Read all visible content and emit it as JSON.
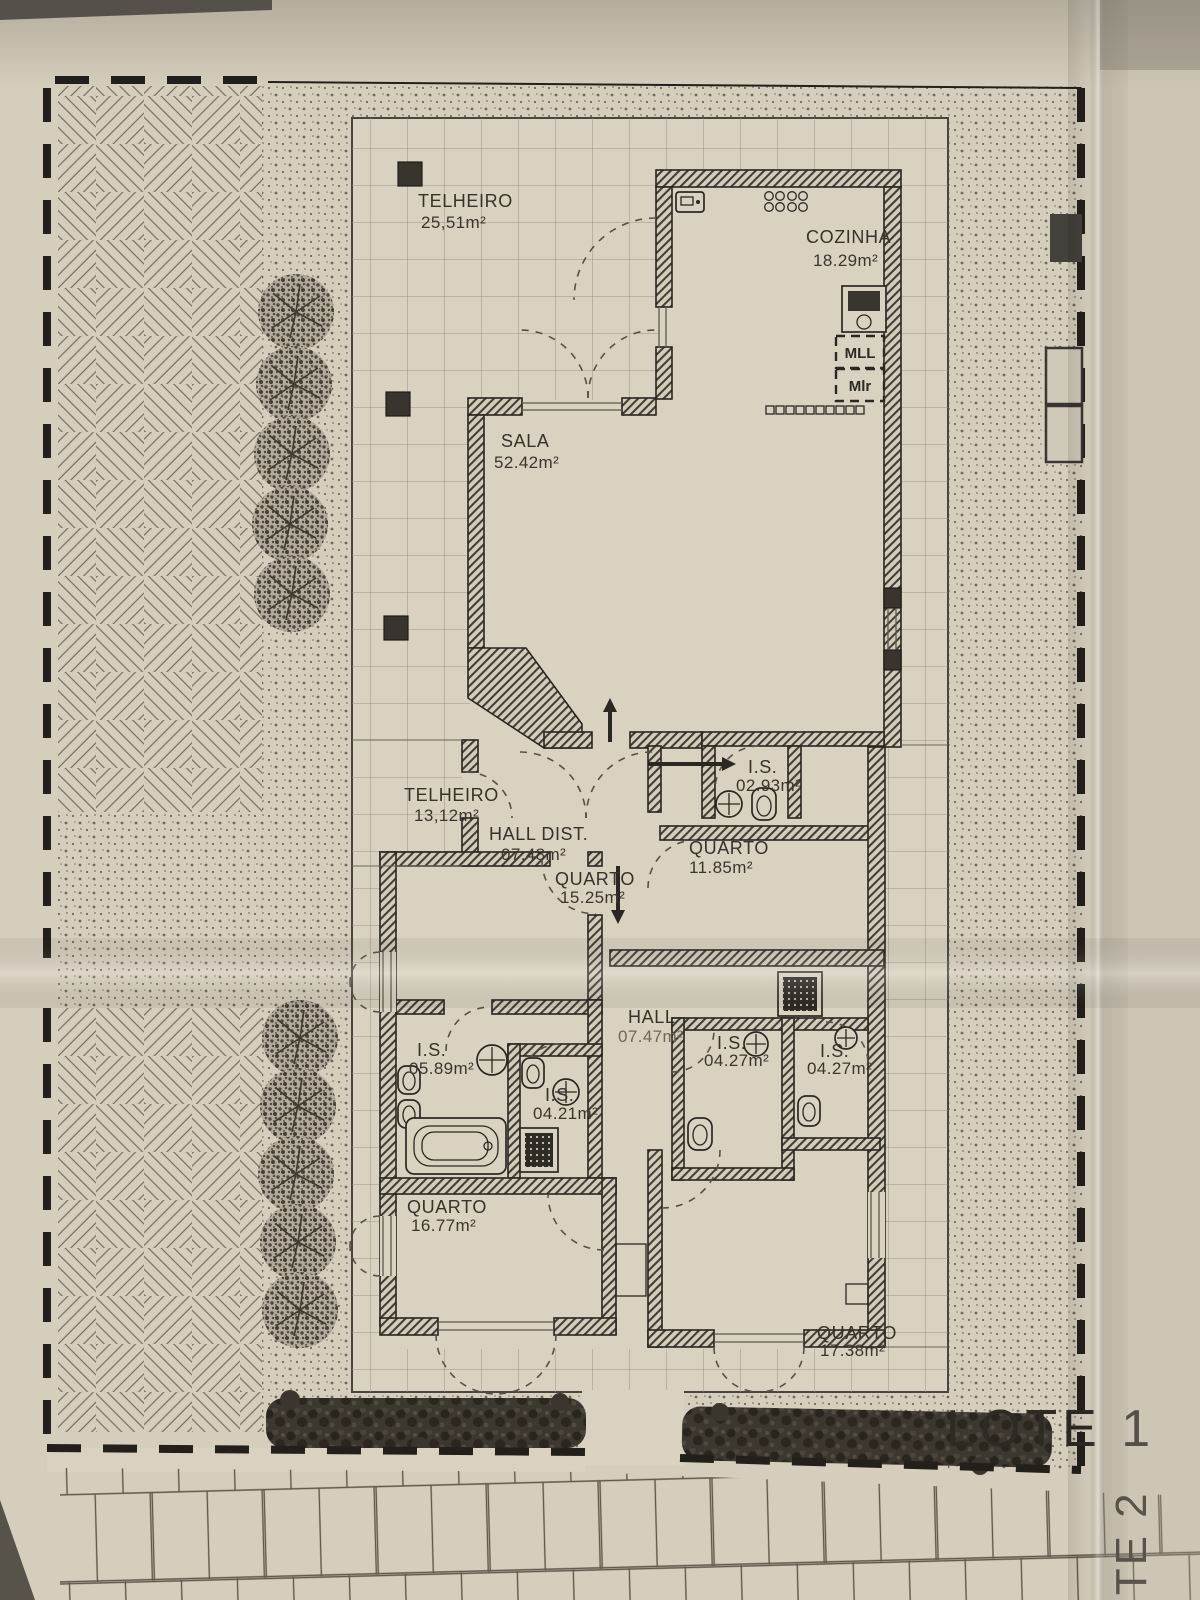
{
  "plan": {
    "lot": {
      "current": "LOTE 1",
      "adjacent": "LOTE 2"
    },
    "rooms": [
      {
        "name": "TELHEIRO",
        "area": "25,51m²"
      },
      {
        "name": "COZINHA",
        "area": "18.29m²"
      },
      {
        "name": "SALA",
        "area": "52.42m²"
      },
      {
        "name": "TELHEIRO",
        "area": "13,12m²"
      },
      {
        "name": "HALL DIST.",
        "area": "07.48m²"
      },
      {
        "name": "QUARTO",
        "area": "15.25m²"
      },
      {
        "name": "I.S.",
        "area": "02.93m²"
      },
      {
        "name": "QUARTO",
        "area": "11.85m²"
      },
      {
        "name": "HALL",
        "area": "07.47m²"
      },
      {
        "name": "I.S.",
        "area": "05.89m²"
      },
      {
        "name": "I.S.",
        "area": "04.21m²"
      },
      {
        "name": "I.S.",
        "area": "04.27m²"
      },
      {
        "name": "I.S.",
        "area": "04.27m²"
      },
      {
        "name": "QUARTO",
        "area": "16.77m²"
      },
      {
        "name": "QUARTO",
        "area": "17.38m²"
      }
    ],
    "appliances": {
      "dishwasher_label": "MLL",
      "washer_label": "Mlr"
    },
    "colors": {
      "paper": "#d6cebd",
      "ink": "#2e2a24",
      "wall": "#45403a",
      "grid_line": "#9b9284"
    }
  }
}
